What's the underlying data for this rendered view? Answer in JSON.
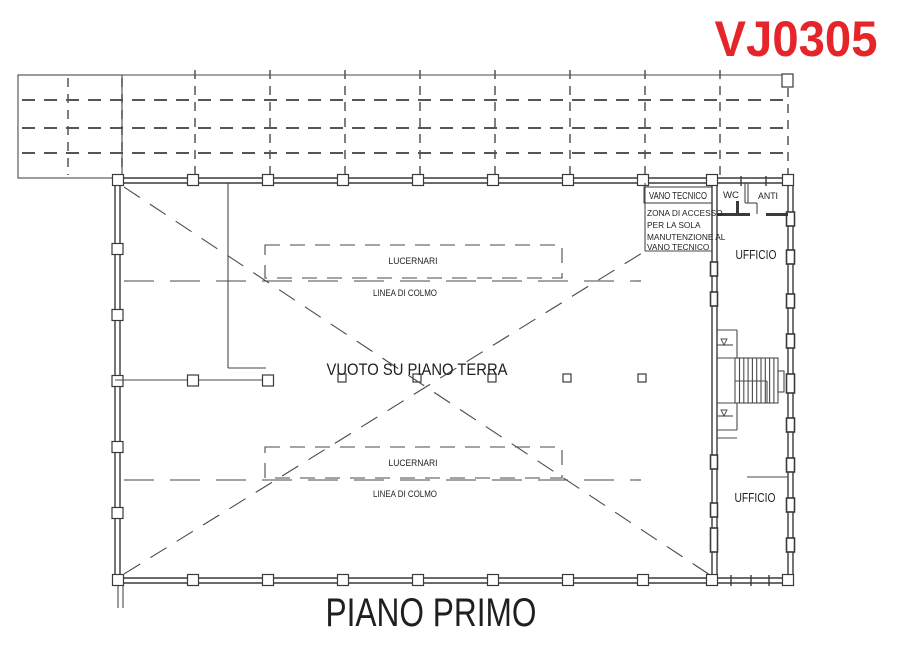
{
  "code": "VJ0305",
  "title": "PIANO PRIMO",
  "labels": {
    "void": "VUOTO SU PIANO TERRA",
    "skylight_top": "LUCERNARI",
    "ridge_top": "LINEA DI COLMO",
    "skylight_bottom": "LUCERNARI",
    "ridge_bottom": "LINEA DI COLMO",
    "tech_room": "VANO TECNICO",
    "access_zone_line1": "ZONA DI ACCESSO",
    "access_zone_line2": "PER LA SOLA",
    "access_zone_line3": "MANUTENZIONE AL",
    "access_zone_line4": "VANO TECNICO",
    "wc": "WC",
    "anteroom": "ANTI",
    "office_top": "UFFICIO",
    "office_bottom": "UFFICIO"
  },
  "colors": {
    "code_red": "#e5252a",
    "line_gray": "#4a4a4a",
    "text_black": "#1f1f1f",
    "background": "#ffffff"
  }
}
